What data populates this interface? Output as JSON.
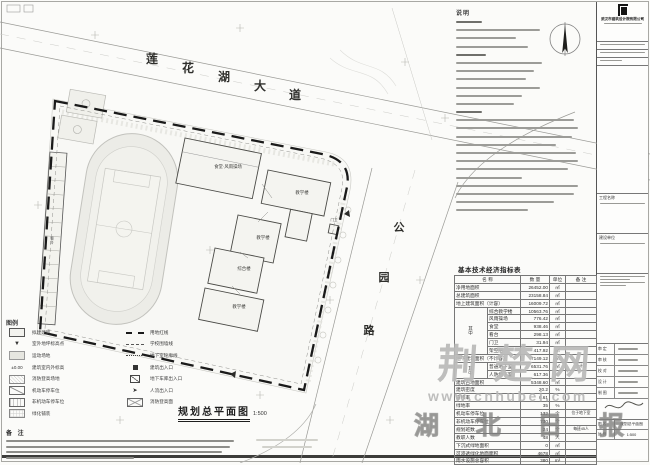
{
  "sheet": {
    "plan_title": "规划总平面图",
    "plan_scale": "1:500"
  },
  "roads": {
    "top": {
      "chars": [
        "莲",
        "花",
        "湖",
        "大",
        "道"
      ]
    },
    "right": {
      "chars": [
        "公",
        "园",
        "路"
      ]
    }
  },
  "site": {
    "buildings": [
      {
        "label": "食堂·风雨操场"
      },
      {
        "label": "教学楼"
      },
      {
        "label": "教学楼"
      },
      {
        "label": "综合楼"
      },
      {
        "label": "教学楼"
      },
      {
        "label": "门卫"
      },
      {
        "label": "看台"
      }
    ]
  },
  "notes": {
    "title": "说明",
    "line_widths": [
      26,
      84,
      60,
      72,
      30,
      86,
      78,
      70,
      84,
      66,
      58,
      26,
      118,
      122,
      116,
      100,
      120,
      122,
      112,
      66,
      122,
      118,
      98,
      72
    ]
  },
  "legend": {
    "title": "图例",
    "left": [
      {
        "sym": "bldg",
        "label": "拟建建筑"
      },
      {
        "sym": "spot",
        "label": "室外地坪标高点"
      },
      {
        "sym": "field",
        "label": "运动场地"
      },
      {
        "sym": "level",
        "label": "建筑室内外标高"
      },
      {
        "sym": "hatch",
        "label": "消防登高场地"
      },
      {
        "sym": "parking",
        "label": "机动车停车位"
      },
      {
        "sym": "bike",
        "label": "非机动车停车位"
      },
      {
        "sym": "paving",
        "label": "绿化铺装"
      }
    ],
    "left_syms": {
      "spot": "▼",
      "level": "±0.00",
      "flow": "➤"
    },
    "right": [
      {
        "sym": "redline",
        "label": "用地红线"
      },
      {
        "sym": "wall",
        "label": "学校围墙线"
      },
      {
        "sym": "basement",
        "label": "地下室轮廓线"
      },
      {
        "sym": "entry",
        "label": "建筑出入口"
      },
      {
        "sym": "garage",
        "label": "地下车库出入口"
      },
      {
        "sym": "flow",
        "label": "人流出入口"
      },
      {
        "sym": "fire",
        "label": "消防登高面"
      }
    ]
  },
  "remarks": {
    "title": "备 注",
    "line_widths": [
      228,
      224,
      216,
      128
    ]
  },
  "table": {
    "title": "基本技术经济指标表",
    "headers": [
      "名  称",
      "数 量",
      "单位",
      "备 注"
    ],
    "rows": [
      {
        "name": "净用地面积",
        "qty": "26452.00",
        "unit": "㎡",
        "remark": ""
      },
      {
        "name": "总建筑面积",
        "qty": "23158.84",
        "unit": "㎡",
        "remark": ""
      },
      {
        "name": "地上建筑面积（计容）",
        "qty": "16009.72",
        "unit": "㎡",
        "remark": ""
      },
      {
        "g": "其中",
        "gspan": 6,
        "name": "综合教学楼",
        "qty": "10563.76",
        "unit": "㎡",
        "remark": ""
      },
      {
        "name": "风雨操场",
        "qty": "776.42",
        "unit": "㎡",
        "remark": ""
      },
      {
        "name": "食堂",
        "qty": "938.46",
        "unit": "㎡",
        "remark": ""
      },
      {
        "name": "看台",
        "qty": "298.13",
        "unit": "㎡",
        "remark": ""
      },
      {
        "name": "门卫",
        "qty": "31.94",
        "unit": "㎡",
        "remark": ""
      },
      {
        "name": "架空层",
        "qty": "417.92",
        "unit": "㎡",
        "remark": ""
      },
      {
        "name": "地下建筑面积（不计容）",
        "qty": "7149.12",
        "unit": "㎡",
        "remark": ""
      },
      {
        "g": "其中",
        "gspan": 2,
        "name": "普通地下室",
        "qty": "6531.76",
        "unit": "㎡",
        "remark": "不计容"
      },
      {
        "name": "人防地下室",
        "qty": "617.36",
        "unit": "㎡",
        "remark": ""
      },
      {
        "name": "建筑占地面积",
        "qty": "5348.60",
        "unit": "㎡",
        "remark": ""
      },
      {
        "name": "建筑密度",
        "qty": "20.2",
        "unit": "%",
        "remark": ""
      },
      {
        "name": "容积率",
        "qty": "0.61",
        "unit": "",
        "remark": ""
      },
      {
        "name": "绿地率",
        "qty": "35",
        "unit": "%",
        "remark": ""
      },
      {
        "name": "机动车停车位",
        "qty": "132",
        "unit": "个",
        "remark": "位于地下室"
      },
      {
        "name": "非机动车停车位",
        "qty": "730",
        "unit": "个",
        "remark": ""
      },
      {
        "name": "规划班数",
        "qty": "24",
        "unit": "个",
        "remark": "每班45人"
      },
      {
        "name": "教职人数",
        "qty": "48",
        "unit": "人",
        "remark": ""
      },
      {
        "name": "下沉式绿地面积",
        "qty": "0",
        "unit": "㎡",
        "remark": ""
      },
      {
        "name": "可渗透绿化地面面积",
        "qty": "4678",
        "unit": "㎡",
        "remark": ""
      },
      {
        "name": "雨水设施总容积",
        "qty": "380",
        "unit": "m³",
        "remark": ""
      }
    ]
  },
  "titleblock": {
    "company": "武汉市建筑设计院有限公司",
    "project_label": "工程名称",
    "client_label": "建设单位",
    "sig_rows": [
      "审 定",
      "审 核",
      "校 对",
      "设 计",
      "制 图"
    ],
    "fields": [
      {
        "label": "图 名",
        "value": "规划总平面图"
      },
      {
        "label": "比 例",
        "value": "1:500"
      }
    ]
  },
  "watermark": {
    "brand": "荆楚网",
    "url": "www.cnhubei.com",
    "site_name": "湖 北 日 报 网"
  },
  "colors": {
    "boundary": "#1a1a1a",
    "site_fill": "#f8f8f5",
    "watermark_gray": "#828280"
  }
}
